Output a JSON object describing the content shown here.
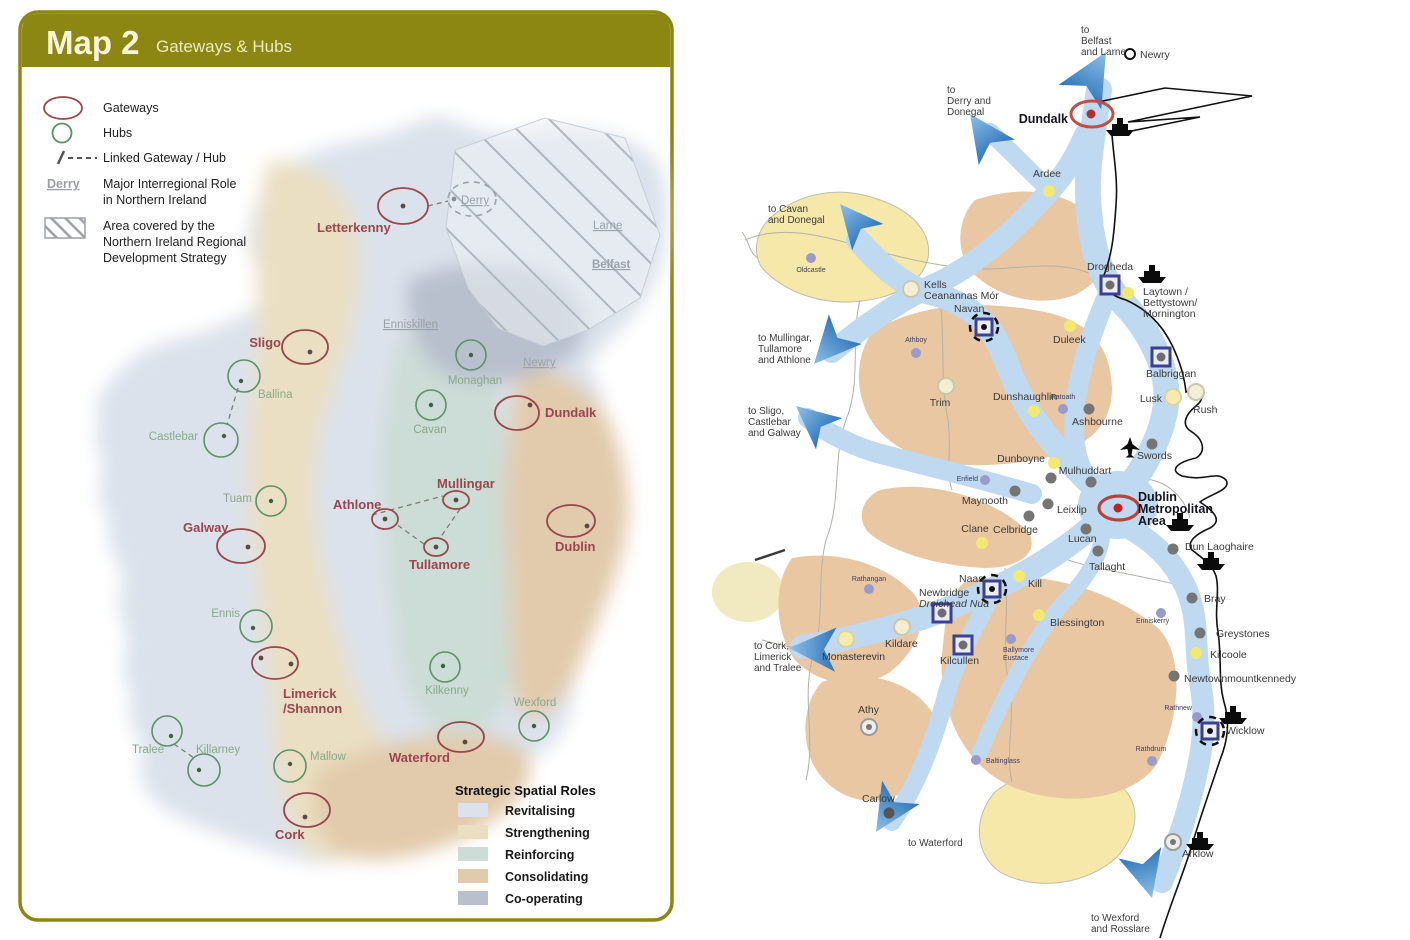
{
  "colors": {
    "panel_olive": "#8c8712",
    "header_text": "#f8f4da",
    "gateway_red": "#99474d",
    "hub_green": "#5d9166",
    "ni_gray": "#9aa2aa",
    "corridor_blue": "#bfd9f1",
    "arrow_blue": "#3f86c8",
    "hinterland_tan": "#e9c7a2",
    "rural_yellow": "#f6e8a8",
    "growth_square_navy": "#3d3f8f",
    "metro_red": "#bf4a40",
    "dot_gray": "#757575",
    "dot_yellow": "#f2e96d",
    "dot_purple": "#9a9bca"
  },
  "left_map": {
    "title": "Map 2",
    "subtitle": "Gateways & Hubs",
    "legend": {
      "gateways": "Gateways",
      "hubs": "Hubs",
      "linked": "Linked Gateway / Hub",
      "derry_sample": "Derry",
      "major_role": [
        "Major Interregional Role",
        "in Northern Ireland"
      ],
      "area_covered": [
        "Area covered by the",
        "Northern Ireland Regional",
        "Development Strategy"
      ]
    },
    "gateways": {
      "letterkenny": "Letterkenny",
      "sligo": "Sligo",
      "dundalk": "Dundalk",
      "galway": "Galway",
      "athlone": "Athlone",
      "mullingar": "Mullingar",
      "tullamore": "Tullamore",
      "dublin": "Dublin",
      "limerick_shannon": [
        "Limerick",
        "/Shannon"
      ],
      "waterford": "Waterford",
      "cork": "Cork"
    },
    "hubs": {
      "ballina": "Ballina",
      "castlebar": "Castlebar",
      "monaghan": "Monaghan",
      "cavan": "Cavan",
      "tuam": "Tuam",
      "ennis": "Ennis",
      "kilkenny": "Kilkenny",
      "wexford": "Wexford",
      "mallow": "Mallow",
      "tralee": "Tralee",
      "killarney": "Killarney"
    },
    "ni": {
      "derry": "Derry",
      "larne": "Larne",
      "belfast": "Belfast",
      "enniskillen": "Enniskillen",
      "newry": "Newry"
    },
    "roles": {
      "title": "Strategic Spatial Roles",
      "items": [
        {
          "label": "Revitalising",
          "color": "#dbe2eb"
        },
        {
          "label": "Strengthening",
          "color": "#eadfc3"
        },
        {
          "label": "Reinforcing",
          "color": "#ccdcd6"
        },
        {
          "label": "Consolidating",
          "color": "#e2cbac"
        },
        {
          "label": "Co-operating",
          "color": "#b8bfcd"
        }
      ]
    }
  },
  "right_map": {
    "routes": {
      "belfast": [
        "to",
        "Belfast",
        "and Larne"
      ],
      "derry": [
        "to",
        "Derry and",
        "Donegal"
      ],
      "cavan": [
        "to Cavan",
        "and Donegal"
      ],
      "mullingar": [
        "to Mullingar,",
        "Tullamore",
        "and Athlone"
      ],
      "sligo": [
        "to Sligo,",
        "Castlebar",
        "and Galway"
      ],
      "cork": [
        "to Cork,",
        "Limerick",
        "and Tralee"
      ],
      "waterford": "to Waterford",
      "wexford": [
        "to Wexford",
        "and Rosslare"
      ]
    },
    "towns": {
      "newry": "Newry",
      "dundalk": "Dundalk",
      "ardee": "Ardee",
      "oldcastle": "Oldcastle",
      "kells": [
        "Kells",
        "Ceanannas Mór"
      ],
      "drogheda": "Drogheda",
      "laytown": [
        "Laytown /",
        "Bettystown/",
        "Mornington"
      ],
      "navan": "Navan",
      "athboy": "Athboy",
      "duleek": "Duleek",
      "balbriggan": "Balbriggan",
      "trim": "Trim",
      "dunshaughlin": "Dunshaughlin",
      "ratoath": "Ratoath",
      "ashbourne": "Ashbourne",
      "lusk": "Lusk",
      "rush": "Rush",
      "dunboyne": "Dunboyne",
      "enfield": "Enfield",
      "swords": "Swords",
      "mulhuddart": "Mulhuddart",
      "maynooth": "Maynooth",
      "leixlip": "Leixlip",
      "celbridge": "Celbridge",
      "clane": "Clane",
      "lucan": "Lucan",
      "tallaght": "Tallaght",
      "dublin": [
        "Dublin",
        "Metropolitan",
        "Area"
      ],
      "dunlaoghaire": "Dun Laoghaire",
      "naas": "Naas",
      "kill": "Kill",
      "newbridge": [
        "Newbridge",
        "Droichead Nua"
      ],
      "rathangan": "Rathangan",
      "kildare": "Kildare",
      "monasterevin": "Monasterevin",
      "kilcullen": "Kilcullen",
      "blessington": "Blessington",
      "ballymore": [
        "Ballymore",
        "Eustace"
      ],
      "enniskerry": "Enniskerry",
      "bray": "Bray",
      "greystones": "Greystones",
      "kilcoole": "Kilcoole",
      "newtownmountkennedy": "Newtownmountkennedy",
      "athy": "Athy",
      "baltinglass": "Baltinglass",
      "rathdrum": "Rathdrum",
      "rathnew": "Rathnew",
      "wicklow": "Wicklow",
      "carlow": "Carlow",
      "arklow": "Arklow"
    }
  }
}
